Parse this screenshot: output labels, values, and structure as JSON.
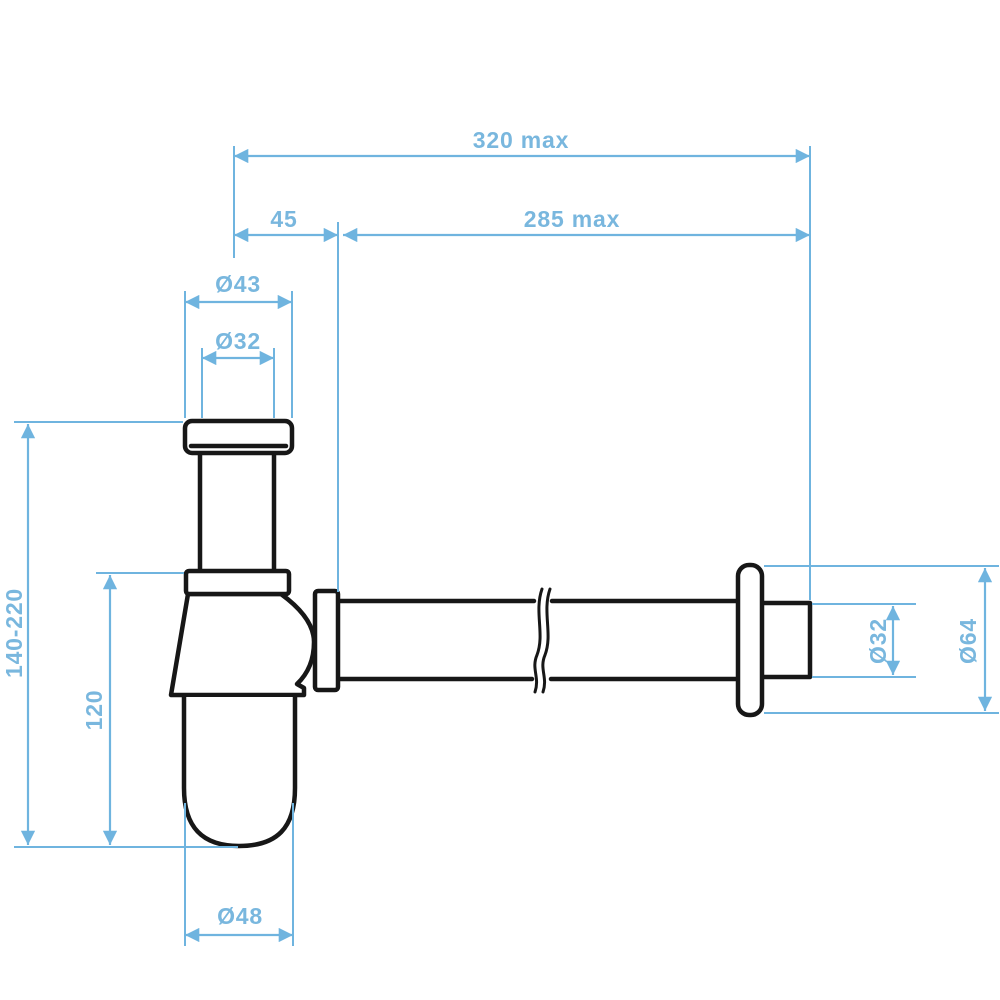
{
  "drawing": {
    "kind": "bottle-trap-dimension-drawing",
    "colors": {
      "dimension_blue": "#6fb4df",
      "label_blue": "#79b7de",
      "outline_black": "#171717",
      "background": "#ffffff"
    },
    "dimensions": {
      "overall_width": {
        "label": "320 max",
        "orientation": "horizontal"
      },
      "inlet_offset": {
        "label": "45",
        "orientation": "horizontal"
      },
      "horizontal_reach": {
        "label": "285 max",
        "orientation": "horizontal"
      },
      "inlet_nut_diameter": {
        "label": "Ø43",
        "orientation": "horizontal"
      },
      "inlet_pipe_diameter": {
        "label": "Ø32",
        "orientation": "horizontal"
      },
      "height_range": {
        "label": "140-220",
        "orientation": "vertical"
      },
      "body_height": {
        "label": "120",
        "orientation": "vertical"
      },
      "cup_diameter": {
        "label": "Ø48",
        "orientation": "horizontal"
      },
      "outlet_pipe_diameter": {
        "label": "Ø32",
        "orientation": "vertical"
      },
      "flange_diameter": {
        "label": "Ø64",
        "orientation": "vertical"
      }
    }
  }
}
